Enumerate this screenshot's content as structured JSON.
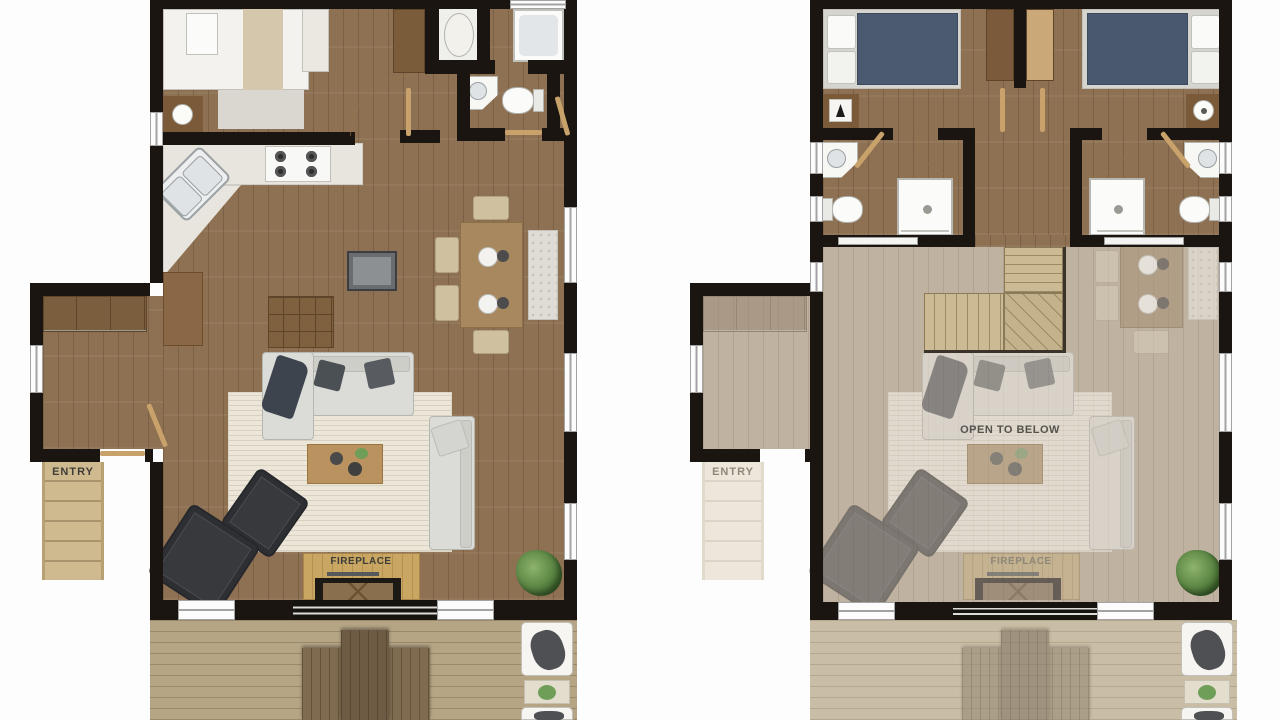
{
  "image_type": "architectural floor plan, two storeys side by side, top-down 3D render style",
  "floor1": {
    "name": "first-floor-plan",
    "labels": {
      "entry": "ENTRY",
      "fireplace": "FIREPLACE"
    },
    "rooms": [
      "bedroom",
      "bathroom",
      "wc",
      "kitchen",
      "dining",
      "living-room",
      "entry-mudroom",
      "deck"
    ]
  },
  "floor2": {
    "name": "second-floor-plan",
    "labels": {
      "entry": "ENTRY",
      "fireplace": "FIREPLACE",
      "open_to_below": "OPEN TO BELOW"
    },
    "rooms": [
      "bedroom-left",
      "bedroom-right",
      "bathroom-left",
      "bathroom-right",
      "hallway",
      "stairs",
      "open-to-below",
      "deck"
    ]
  },
  "colors": {
    "wall": "#1a1510",
    "floor_wood": "#8e7153",
    "floor_faded": "#c0b2a0",
    "deck_wood": "#b5a585",
    "rug_cream": "#ece6d9",
    "counter": "#e7e5dd",
    "bed_navy": "#4b5a70",
    "stairs_tan": "#ccba95",
    "hearth_gold": "#c9a763",
    "plant_green": "#5d8745",
    "background": "#fdfdfd"
  }
}
